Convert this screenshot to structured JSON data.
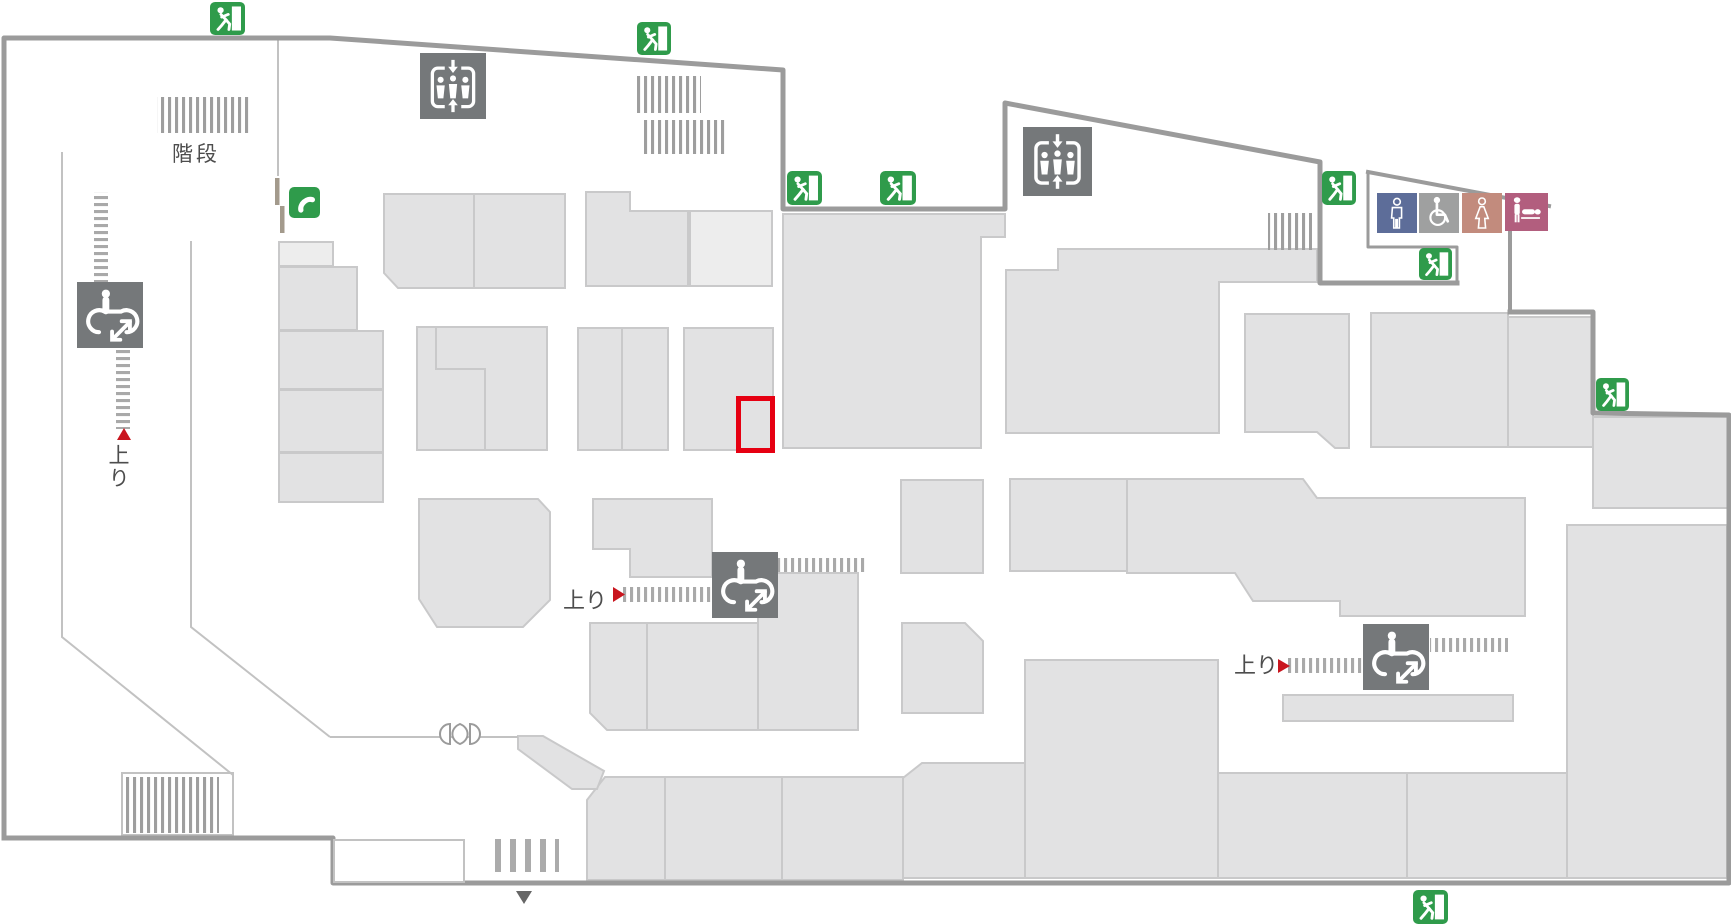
{
  "map": {
    "kind": "floor-plan",
    "labels": {
      "stairs": "階段",
      "up_left": "上り",
      "up_center": "上り",
      "up_right": "上り"
    },
    "markers": {
      "highlight_box_color": "#e60012",
      "escalator_direction_arrow_color": "#c9151e",
      "entrance_arrow_color": "#666666"
    },
    "icons": {
      "emergency_exit": {
        "semantic": "emergency-exit-running-man",
        "color": "#2f9b4b",
        "count": 8
      },
      "elevator": {
        "semantic": "elevator-people-arrows",
        "color": "#75787a",
        "count": 2
      },
      "escalator": {
        "semantic": "escalator-person",
        "color": "#75787a",
        "count": 3
      },
      "public_phone": {
        "semantic": "telephone-handset",
        "color": "#2f9b4b",
        "count": 1
      },
      "toilet_men": {
        "semantic": "mens-toilet",
        "color": "#5d6d99",
        "count": 1
      },
      "toilet_accessible": {
        "semantic": "wheelchair-accessible-toilet",
        "color": "#9fa0a0",
        "count": 1
      },
      "toilet_women": {
        "semantic": "womens-toilet",
        "color": "#c28b7d",
        "count": 1
      },
      "baby_changing": {
        "semantic": "baby-changing-station",
        "color": "#b25e7e",
        "count": 1
      }
    },
    "colors": {
      "wall": "#9b9b9b",
      "corridor_line": "#c2c2c2",
      "room_fill": "#e2e2e3",
      "room_border": "#c9c9ca",
      "room_fill_light": "#ededed",
      "stairs_hatch": "#9e9e9e",
      "escalator_hatch": "#a9a9a9",
      "background": "#ffffff",
      "text": "#4d4d4d"
    }
  }
}
